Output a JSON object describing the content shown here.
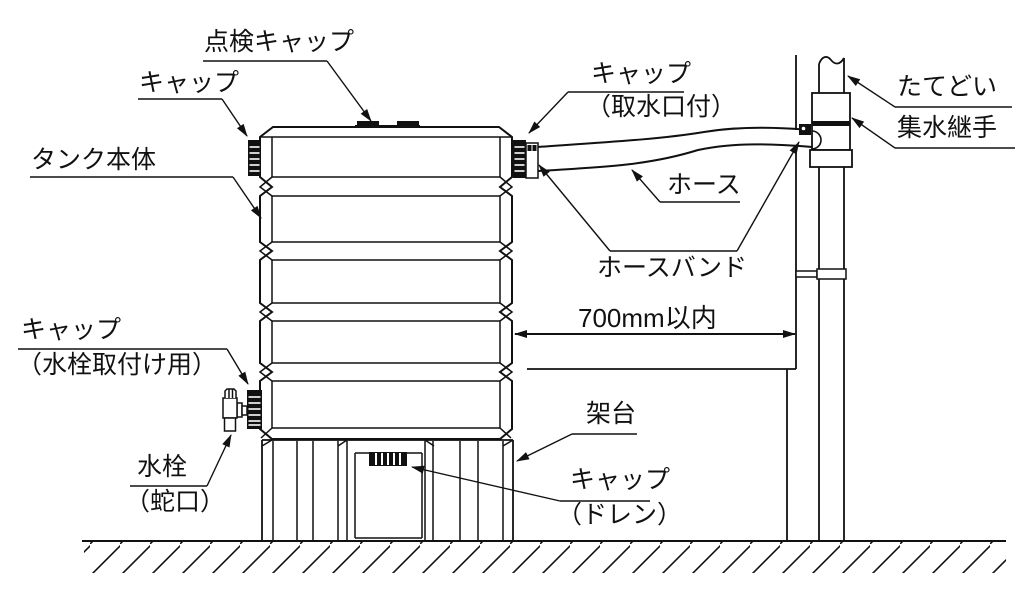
{
  "labels": {
    "inspection_cap": "点検キャップ",
    "cap": "キャップ",
    "tank_body": "タンク本体",
    "cap_intake_1": "キャップ",
    "cap_intake_2": "（取水口付）",
    "hose": "ホース",
    "hose_band": "ホースバンド",
    "downspout": "たてどい",
    "collector_fitting": "集水継手",
    "dimension": "700mm以内",
    "stand": "架台",
    "cap_drain_1": "キャップ",
    "cap_drain_2": "（ドレン）",
    "cap_faucet_1": "キャップ",
    "cap_faucet_2": "（水栓取付け用）",
    "faucet_1": "水栓",
    "faucet_2": "（蛇口）"
  },
  "colors": {
    "line": "#111111",
    "background": "#ffffff"
  }
}
